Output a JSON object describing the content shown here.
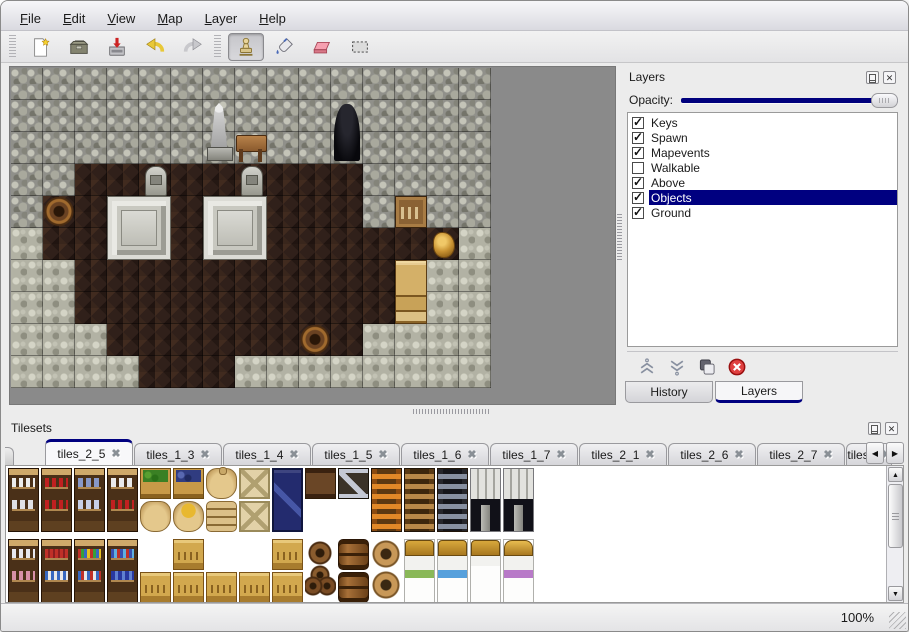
{
  "menu_bar": {
    "items": [
      "File",
      "Edit",
      "View",
      "Map",
      "Layer",
      "Help"
    ]
  },
  "toolbar": {
    "groups": [
      {
        "name": "file-actions",
        "buttons": [
          {
            "name": "new-map-button",
            "icon": "new-file-icon",
            "active": false
          },
          {
            "name": "open-map-button",
            "icon": "open-folder-icon",
            "active": false
          },
          {
            "name": "save-map-button",
            "icon": "save-icon",
            "active": false
          },
          {
            "name": "undo-button",
            "icon": "undo-icon",
            "active": false
          },
          {
            "name": "redo-button",
            "icon": "redo-icon",
            "active": false
          }
        ]
      },
      {
        "name": "tool-group",
        "buttons": [
          {
            "name": "stamp-tool-button",
            "icon": "stamp-icon",
            "active": true
          },
          {
            "name": "fill-tool-button",
            "icon": "fill-icon",
            "active": false
          },
          {
            "name": "eraser-tool-button",
            "icon": "eraser-icon",
            "active": false
          },
          {
            "name": "select-tool-button",
            "icon": "select-icon",
            "active": false
          }
        ]
      }
    ]
  },
  "map_view": {
    "tile_size": 32,
    "legend": {
      "W": "stone-wall",
      "F": "wood-floor",
      "G": "stone-ground"
    },
    "grid": [
      "WWWWWWWWWWWWWWW",
      "WWWWWWWWWWWWWWW",
      "WWWWWWWWWWWWWWW",
      "WWFFFFFFFFFWWWW",
      "WFFFFFFFFFFWFWW",
      "GFFFFFFFFFFFFFG",
      "GGFFFFFFFFFFFGG",
      "GGFFFFFFFFFFFGG",
      "GGGFFFFFFFFGGGG",
      "GGGGFFFGGGGGGGG"
    ],
    "objects": [
      {
        "name": "statue",
        "col": 6,
        "row": 1,
        "w": 1,
        "h": 2
      },
      {
        "name": "cave-entrance",
        "col": 10,
        "row": 1,
        "w": 1,
        "h": 2
      },
      {
        "name": "table",
        "col": 7,
        "row": 2,
        "w": 1,
        "h": 1
      },
      {
        "name": "gravestone",
        "col": 4,
        "row": 3,
        "w": 1,
        "h": 1
      },
      {
        "name": "gravestone",
        "col": 7,
        "row": 3,
        "w": 1,
        "h": 1
      },
      {
        "name": "barrel",
        "col": 1,
        "row": 4,
        "w": 1,
        "h": 1
      },
      {
        "name": "pedestal",
        "col": 3,
        "row": 4,
        "w": 2,
        "h": 2
      },
      {
        "name": "pedestal",
        "col": 6,
        "row": 4,
        "w": 2,
        "h": 2
      },
      {
        "name": "crate-shelf",
        "col": 12,
        "row": 4,
        "w": 1,
        "h": 1
      },
      {
        "name": "gold-pot",
        "col": 13,
        "row": 5,
        "w": 1,
        "h": 1
      },
      {
        "name": "wardrobe",
        "col": 12,
        "row": 6,
        "w": 1,
        "h": 2
      },
      {
        "name": "barrel",
        "col": 9,
        "row": 8,
        "w": 1,
        "h": 1
      }
    ]
  },
  "layers_panel": {
    "title": "Layers",
    "opacity_label": "Opacity:",
    "opacity_percent": 100,
    "layers": [
      {
        "label": "Keys",
        "checked": true,
        "selected": false
      },
      {
        "label": "Spawn",
        "checked": true,
        "selected": false
      },
      {
        "label": "Mapevents",
        "checked": true,
        "selected": false
      },
      {
        "label": "Walkable",
        "checked": false,
        "selected": false
      },
      {
        "label": "Above",
        "checked": true,
        "selected": false
      },
      {
        "label": "Objects",
        "checked": true,
        "selected": true
      },
      {
        "label": "Ground",
        "checked": true,
        "selected": false
      }
    ],
    "buttons": [
      {
        "name": "raise-layer-button",
        "icon": "raise-layer-icon"
      },
      {
        "name": "lower-layer-button",
        "icon": "lower-layer-icon"
      },
      {
        "name": "duplicate-layer-button",
        "icon": "duplicate-layer-icon"
      },
      {
        "name": "delete-layer-button",
        "icon": "delete-layer-icon"
      }
    ],
    "tabs": [
      {
        "label": "History",
        "active": false
      },
      {
        "label": "Layers",
        "active": true
      }
    ]
  },
  "tilesets_panel": {
    "title": "Tilesets",
    "tabs": [
      {
        "label": "tiles_2_5",
        "active": true
      },
      {
        "label": "tiles_1_3",
        "active": false
      },
      {
        "label": "tiles_1_4",
        "active": false
      },
      {
        "label": "tiles_1_5",
        "active": false
      },
      {
        "label": "tiles_1_6",
        "active": false
      },
      {
        "label": "tiles_1_7",
        "active": false
      },
      {
        "label": "tiles_2_1",
        "active": false
      },
      {
        "label": "tiles_2_6",
        "active": false
      },
      {
        "label": "tiles_2_7",
        "active": false
      },
      {
        "label": "tiles_",
        "active": false
      }
    ],
    "tiles": [
      {
        "name": "shelf-dishes",
        "col": 0,
        "row": 0,
        "w": 1,
        "h": 2
      },
      {
        "name": "shelf-bottles-red",
        "col": 1,
        "row": 0,
        "w": 1,
        "h": 2
      },
      {
        "name": "shelf-plates-blue",
        "col": 2,
        "row": 0,
        "w": 1,
        "h": 2
      },
      {
        "name": "shelf-jugs",
        "col": 3,
        "row": 0,
        "w": 1,
        "h": 2
      },
      {
        "name": "crate-produce",
        "col": 4,
        "row": 0,
        "w": 1,
        "h": 1
      },
      {
        "name": "crate-berries",
        "col": 5,
        "row": 0,
        "w": 1,
        "h": 1
      },
      {
        "name": "sack-tall",
        "col": 6,
        "row": 0,
        "w": 1,
        "h": 1
      },
      {
        "name": "crate-pale",
        "col": 7,
        "row": 0,
        "w": 1,
        "h": 1
      },
      {
        "name": "crate-navy",
        "col": 8,
        "row": 0,
        "w": 1,
        "h": 2
      },
      {
        "name": "sack-round",
        "col": 4,
        "row": 1,
        "w": 1,
        "h": 1
      },
      {
        "name": "sack-open",
        "col": 5,
        "row": 1,
        "w": 1,
        "h": 1
      },
      {
        "name": "sack-stack",
        "col": 6,
        "row": 1,
        "w": 1,
        "h": 1
      },
      {
        "name": "crate-pale",
        "col": 7,
        "row": 1,
        "w": 1,
        "h": 1
      },
      {
        "name": "crate-strapped",
        "col": 9,
        "row": 0,
        "w": 1,
        "h": 1
      },
      {
        "name": "crate-metal-z",
        "col": 10,
        "row": 0,
        "w": 1,
        "h": 1
      },
      {
        "name": "ladder-orange",
        "col": 11,
        "row": 0,
        "w": 1,
        "h": 2
      },
      {
        "name": "ladder-brown",
        "col": 12,
        "row": 0,
        "w": 1,
        "h": 2
      },
      {
        "name": "ladder-dark",
        "col": 13,
        "row": 0,
        "w": 1,
        "h": 2
      },
      {
        "name": "stone-arch",
        "col": 14,
        "row": 0,
        "w": 1,
        "h": 2
      },
      {
        "name": "stone-arch",
        "col": 15,
        "row": 0,
        "w": 1,
        "h": 2
      },
      {
        "name": "shelf-jars",
        "col": 0,
        "row": 2,
        "w": 1,
        "h": 2
      },
      {
        "name": "shelf-books-red",
        "col": 1,
        "row": 2,
        "w": 1,
        "h": 2
      },
      {
        "name": "shelf-books-multi",
        "col": 2,
        "row": 2,
        "w": 1,
        "h": 2
      },
      {
        "name": "shelf-books-blue",
        "col": 3,
        "row": 2,
        "w": 1,
        "h": 2
      },
      {
        "name": "crate-tan",
        "col": 5,
        "row": 2,
        "w": 1,
        "h": 1
      },
      {
        "name": "crate-tan",
        "col": 8,
        "row": 2,
        "w": 1,
        "h": 1
      },
      {
        "name": "crate-tan",
        "col": 4,
        "row": 3,
        "w": 1,
        "h": 1
      },
      {
        "name": "crate-tan",
        "col": 5,
        "row": 3,
        "w": 1,
        "h": 1
      },
      {
        "name": "crate-tan",
        "col": 6,
        "row": 3,
        "w": 1,
        "h": 1
      },
      {
        "name": "crate-tan",
        "col": 7,
        "row": 3,
        "w": 1,
        "h": 1
      },
      {
        "name": "crate-tan",
        "col": 8,
        "row": 3,
        "w": 1,
        "h": 1
      },
      {
        "name": "barrel-cluster",
        "col": 9,
        "row": 2,
        "w": 1,
        "h": 2
      },
      {
        "name": "barrel",
        "col": 10,
        "row": 2,
        "w": 1,
        "h": 1
      },
      {
        "name": "barrel",
        "col": 10,
        "row": 3,
        "w": 1,
        "h": 1
      },
      {
        "name": "pot-stack",
        "col": 11,
        "row": 2,
        "w": 1,
        "h": 2
      },
      {
        "name": "bed-green",
        "col": 12,
        "row": 2,
        "w": 1,
        "h": 2
      },
      {
        "name": "bed-blue",
        "col": 13,
        "row": 2,
        "w": 1,
        "h": 2
      },
      {
        "name": "bed-plain",
        "col": 14,
        "row": 2,
        "w": 1,
        "h": 2
      },
      {
        "name": "bed-purple",
        "col": 15,
        "row": 2,
        "w": 1,
        "h": 2
      }
    ]
  },
  "status_bar": {
    "zoom_level": "100%"
  },
  "colors": {
    "selection_navy": "#000080",
    "window_bg": "#ececec",
    "map_background": "#8a8a8a",
    "slider_track": "#00007d"
  }
}
